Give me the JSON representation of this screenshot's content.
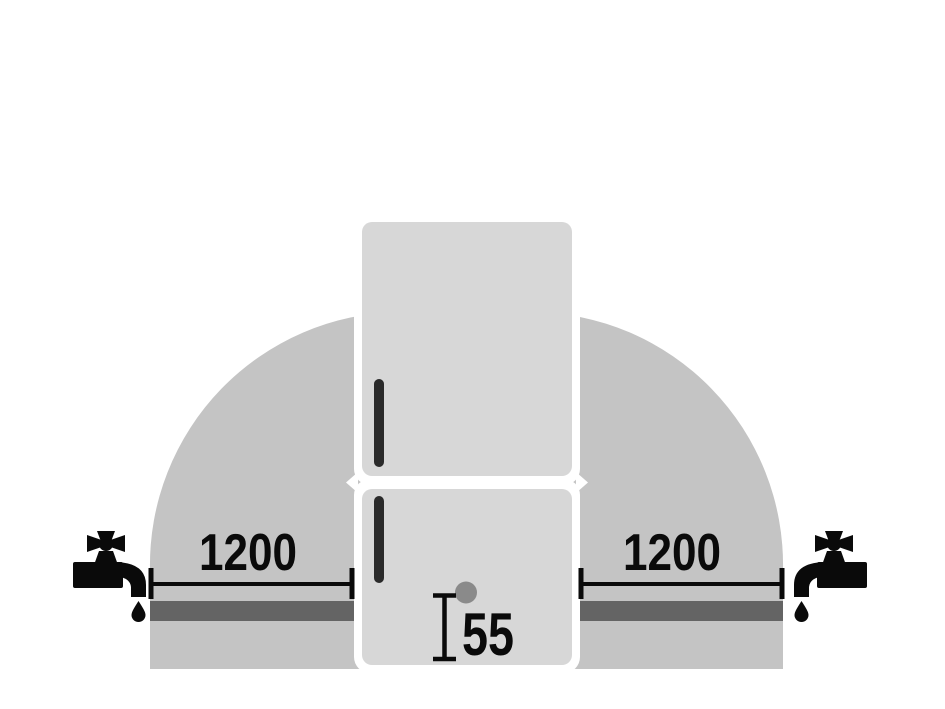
{
  "diagram": {
    "labels": {
      "left_clearance": "1200",
      "right_clearance": "1200",
      "bottom_offset": "55"
    },
    "colors": {
      "background": "#ffffff",
      "clearance_zone": "#c4c4c4",
      "pipe_band": "#646464",
      "appliance": "#d7d7d7",
      "outline": "#ffffff",
      "door_handle": "#2a2a2a",
      "inlet_dot": "#8a8a8a",
      "ink": "#0a0a0a"
    },
    "icons": {
      "left_faucet": "faucet-icon",
      "right_faucet": "faucet-icon"
    }
  }
}
